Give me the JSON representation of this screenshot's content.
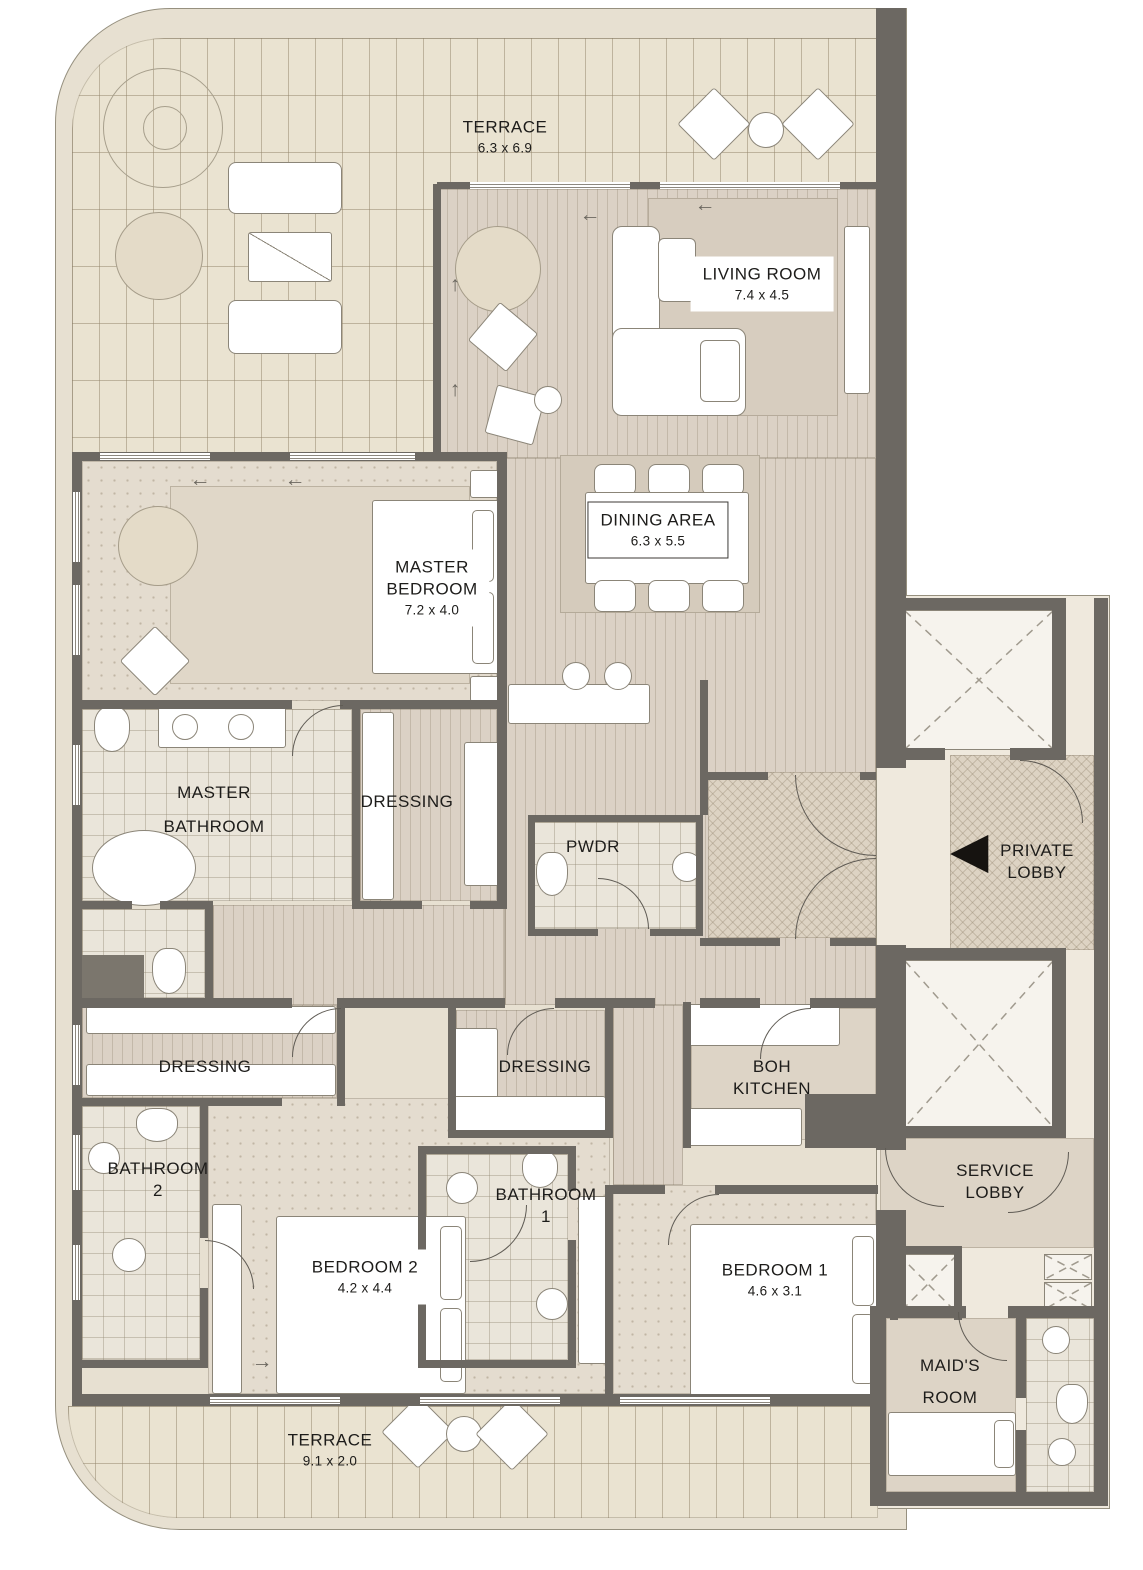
{
  "plan": {
    "type": "apartment-floor-plan"
  },
  "rooms": {
    "terrace_top": {
      "name": "TERRACE",
      "dims": "6.3 x 6.9"
    },
    "living_room": {
      "name": "LIVING ROOM",
      "dims": "7.4 x 4.5"
    },
    "dining_area": {
      "name": "DINING AREA",
      "dims": "6.3 x 5.5"
    },
    "master_bedroom": {
      "line1": "MASTER",
      "line2": "BEDROOM",
      "dims": "7.2 x 4.0"
    },
    "master_bathroom": {
      "line1": "MASTER",
      "line2": "BATHROOM"
    },
    "dressing_master": {
      "name": "DRESSING"
    },
    "powder_room": {
      "name": "PWDR"
    },
    "private_lobby": {
      "line1": "PRIVATE",
      "line2": "LOBBY"
    },
    "dressing_left": {
      "name": "DRESSING"
    },
    "dressing_middle": {
      "name": "DRESSING"
    },
    "boh_kitchen": {
      "line1": "BOH",
      "line2": "KITCHEN"
    },
    "bathroom_2": {
      "line1": "BATHROOM",
      "line2": "2"
    },
    "bathroom_1": {
      "line1": "BATHROOM",
      "line2": "1"
    },
    "bedroom_2": {
      "name": "BEDROOM 2",
      "dims": "4.2 x 4.4"
    },
    "bedroom_1": {
      "name": "BEDROOM 1",
      "dims": "4.6 x 3.1"
    },
    "service_lobby": {
      "line1": "SERVICE",
      "line2": "LOBBY"
    },
    "maids_room": {
      "line1": "MAID'S",
      "line2": "ROOM"
    },
    "terrace_bottom": {
      "name": "TERRACE",
      "dims": "9.1 x 2.0"
    }
  },
  "icons": {
    "arrow_left": "←",
    "arrow_up": "↑",
    "arrow_right": "→",
    "entry_marker": "◀"
  },
  "colors": {
    "wall": "#6c6862",
    "slab": "#e7e0d1",
    "wood_floor": "#dbd1c5",
    "tile_floor": "#eae5da",
    "brick_terrace": "#eae3d1",
    "entry_marker": "#161310"
  }
}
